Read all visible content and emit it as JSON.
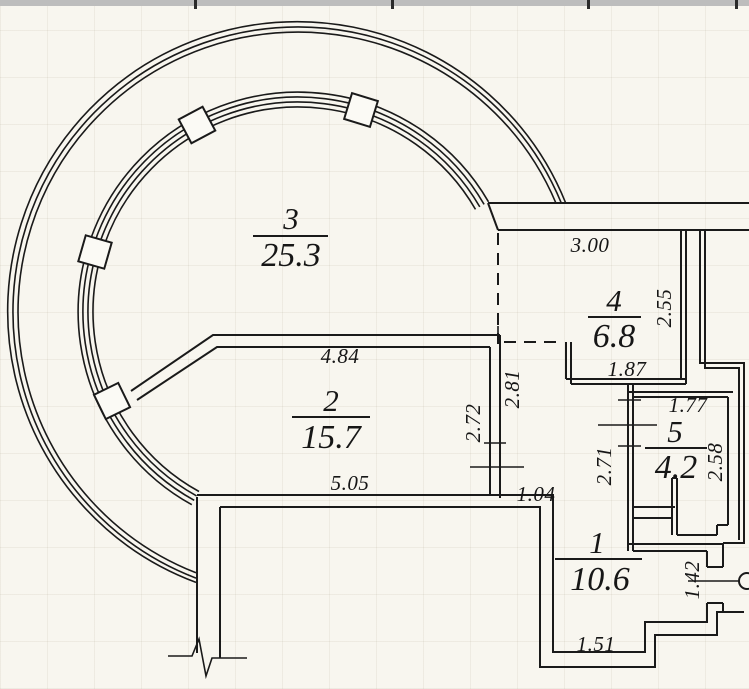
{
  "page": {
    "kind": "scanned apartment floor plan",
    "paper_color": "#f8f6ef",
    "ink_color": "#1a1a1a",
    "scanner_bar_color": "#bdbdbd"
  },
  "rooms": [
    {
      "number": "1",
      "area": "10.6"
    },
    {
      "number": "2",
      "area": "15.7"
    },
    {
      "number": "3",
      "area": "25.3"
    },
    {
      "number": "4",
      "area": "6.8"
    },
    {
      "number": "5",
      "area": "4.2"
    }
  ],
  "dimensions": {
    "room4_top_width": "3.00",
    "room4_right_height": "2.55",
    "room4_bottom_width": "1.87",
    "room5_top_width": "1.77",
    "hall_left_height": "2.81",
    "room2_right_height": "2.72",
    "room5_left_height": "2.71",
    "room5_right_height": "2.58",
    "room2_top_width": "4.84",
    "room2_bottom_width": "5.05",
    "opening_width": "1.04",
    "room1_door_height": "1.42",
    "room1_bottom_width": "1.51"
  }
}
